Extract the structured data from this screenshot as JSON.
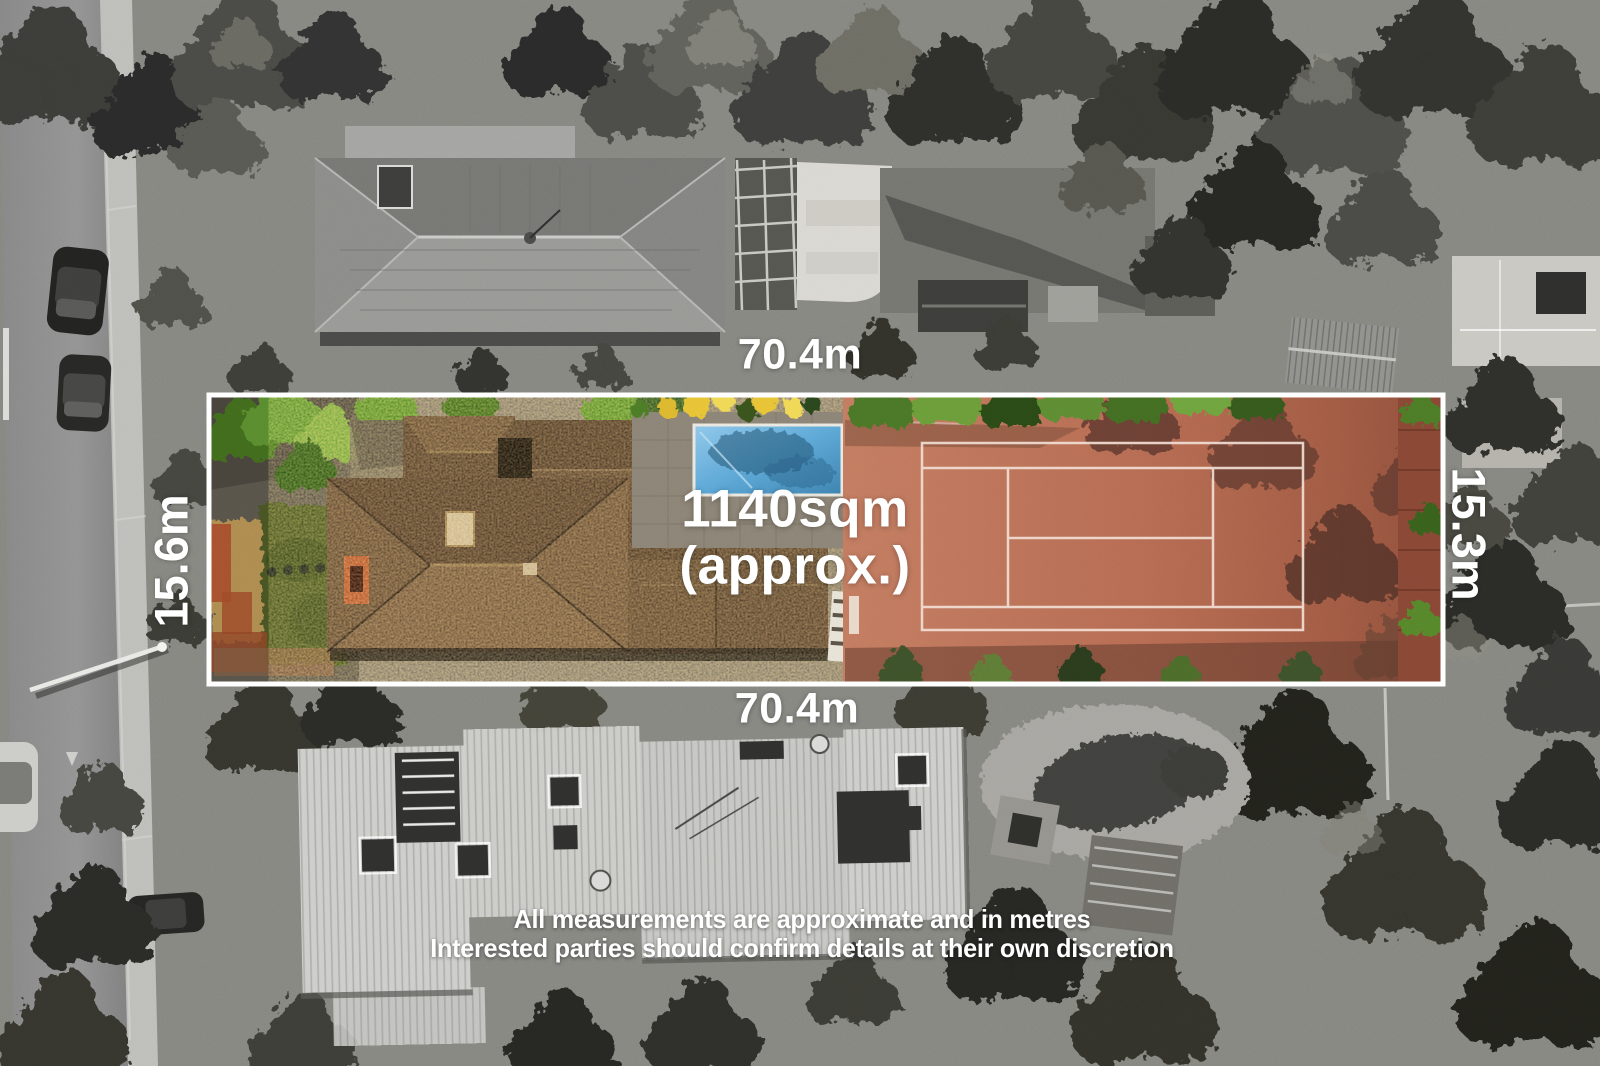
{
  "overlay": {
    "boundary_color": "#ffffff",
    "area_label": {
      "line1": "1140sqm",
      "line2": "(approx.)"
    },
    "measurements": {
      "top": "70.4m",
      "bottom": "70.4m",
      "left": "15.6m",
      "right": "15.3m"
    },
    "disclaimer": {
      "line1": "All measurements are approximate and in metres",
      "line2": "Interested parties should confirm details at their own discretion"
    }
  },
  "scene_colors": {
    "tennis_court_clay": "#b56a51",
    "court_line_white": "#f2ddd2",
    "pool_water_blue": "#5ba6d6",
    "roof_tile_brown": "#57432f",
    "foliage_green": "#55842c",
    "grayscale_surroundings": "#8a8a8a"
  }
}
